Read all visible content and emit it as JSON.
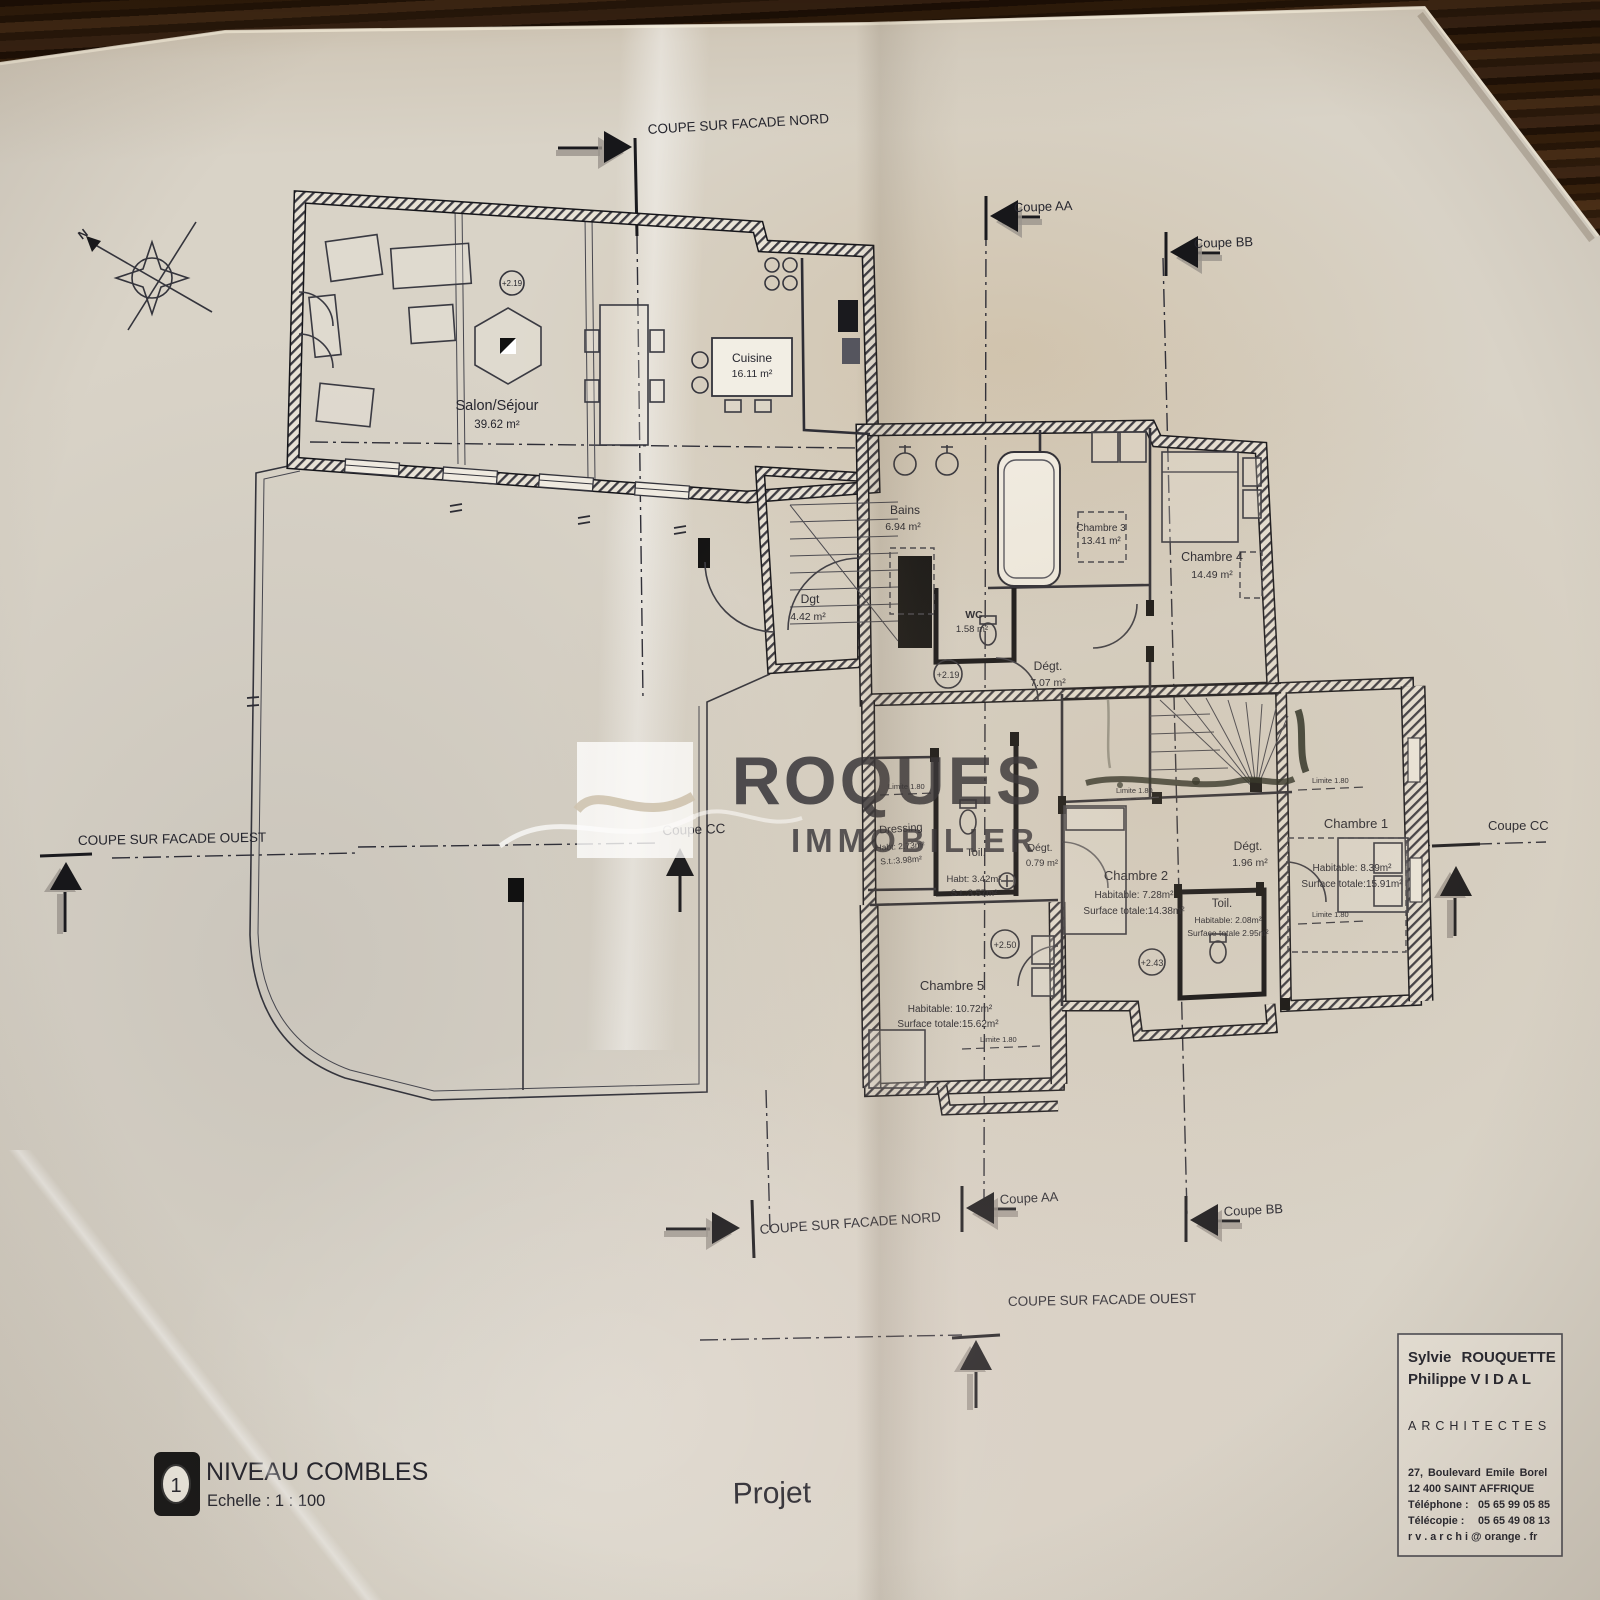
{
  "sections": {
    "facade_nord": "COUPE SUR FACADE NORD",
    "facade_ouest": "COUPE SUR FACADE OUEST",
    "coupe_aa": "Coupe AA",
    "coupe_bb": "Coupe BB",
    "coupe_cc": "Coupe CC"
  },
  "compass": {
    "north_label": "N"
  },
  "rooms": {
    "salon": {
      "name": "Salon/Séjour",
      "area": "39.62 m²"
    },
    "cuisine": {
      "name": "Cuisine",
      "area": "16.11 m²"
    },
    "bains": {
      "name": "Bains",
      "area": "6.94 m²"
    },
    "chambre3": {
      "name": "Chambre 3",
      "area": "13.41 m²"
    },
    "chambre4": {
      "name": "Chambre 4",
      "area": "14.49 m²"
    },
    "wc": {
      "name": "WC",
      "area": "1.58 m²"
    },
    "dgt": {
      "name": "Dgt",
      "area": "4.42 m²"
    },
    "degt7": {
      "name": "Dégt.",
      "area": "7.07 m²"
    },
    "dressing": {
      "name": "Dressing",
      "hab": "Habt: 2.73m²",
      "surf": "S.t.:3.98m²"
    },
    "toil_ouest": {
      "name": "Toil.",
      "hab": "Habt: 3.42m²",
      "surf": "S.t.:3.57m²"
    },
    "degt0": {
      "name": "Dégt.",
      "area": "0.79 m²"
    },
    "chambre2": {
      "name": "Chambre 2",
      "hab": "Habitable: 7.28m²",
      "surf": "Surface totale:14.38m²"
    },
    "degt1": {
      "name": "Dégt.",
      "area": "1.96 m²"
    },
    "toil_est": {
      "name": "Toil.",
      "hab": "Habitable: 2.08m²",
      "surf": "Surface totale 2.95m²"
    },
    "chambre1": {
      "name": "Chambre 1",
      "hab": "Habitable: 8.39m²",
      "surf": "Surface totale:15.91m²"
    },
    "chambre5": {
      "name": "Chambre 5",
      "hab": "Habitable: 10.72m²",
      "surf": "Surface totale:15.62m²"
    }
  },
  "levels": {
    "salon": "+2.19",
    "palier": "+2.19",
    "chambre5": "+2.50",
    "toilettes": "+2.43"
  },
  "annotations": {
    "limite": "Limite 1.80"
  },
  "watermark": {
    "name": "ROQUES",
    "subtitle": "IMMOBILIER"
  },
  "title_block": {
    "architect1": "Sylvie  ROUQUETTE",
    "architect2": "Philippe  V I D A L",
    "profession": "ARCHITECTES",
    "address1": "27, Boulevard Emile Borel",
    "address2": "12 400    SAINT AFFRIQUE",
    "phone_label": "Téléphone :",
    "phone": "05 65 99 05 85",
    "fax_label": "Télécopie :",
    "fax": "05 65 49 08 13",
    "email": "r v . a r c h i @ orange . fr"
  },
  "drawing_title": {
    "index": "1",
    "name": "NIVEAU COMBLES",
    "scale": "Echelle :  1 : 100"
  },
  "project": {
    "label": "Projet"
  }
}
